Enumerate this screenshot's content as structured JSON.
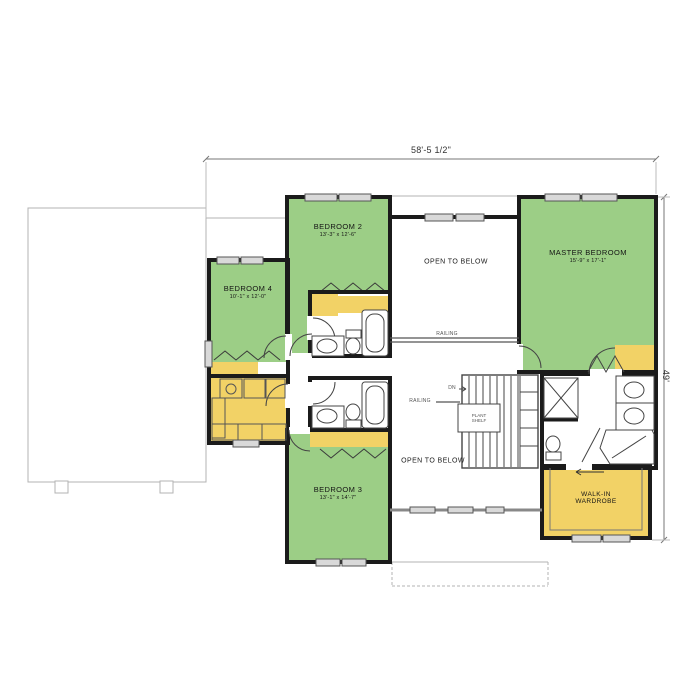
{
  "dimensions": {
    "top": "58'-5 1/2\"",
    "right": "49'"
  },
  "rooms": {
    "bedroom2": {
      "name": "BEDROOM 2",
      "size": "13'-3\" x 12'-6\""
    },
    "bedroom3": {
      "name": "BEDROOM 3",
      "size": "13'-1\" x 14'-7\""
    },
    "bedroom4": {
      "name": "BEDROOM 4",
      "size": "10'-1\" x 12'-0\""
    },
    "master_bedroom": {
      "name": "MASTER BEDROOM",
      "size": "15'-9\" x 17'-1\""
    },
    "walk_in_wardrobe": {
      "line1": "WALK-IN",
      "line2": "WARDROBE"
    },
    "open_to_below_top": "OPEN TO BELOW",
    "open_to_below_bottom": "OPEN TO BELOW"
  },
  "annotations": {
    "railing_top": "RAILING",
    "railing_stairs": "RAILING",
    "plant_shelf_line1": "PLANT",
    "plant_shelf_line2": "SHELF",
    "stairs_down": "DN"
  },
  "colors": {
    "bedroom_fill": "#9cce86",
    "closet_fill": "#f2d266",
    "wall": "#1b1b1b",
    "window_fill": "#d9d9d9",
    "reference_outline": "#b3b3b3"
  }
}
